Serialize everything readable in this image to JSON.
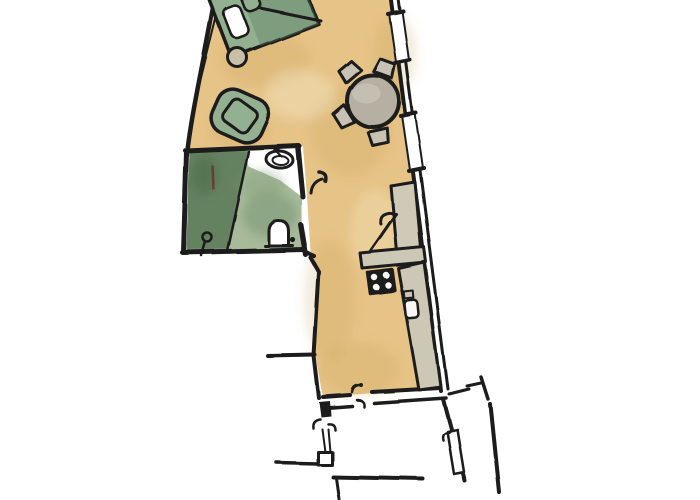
{
  "colors": {
    "paper": "#ffffff",
    "outline": "#1d1d1b",
    "floor": "#e6c387",
    "floor_shade": "#c59c4f",
    "green": "#93b191",
    "green_dark": "#5d7f5f",
    "bath": "#a7bb9a",
    "shower": "#5f7d5c",
    "table": "#b5b0a2",
    "chair": "#c7c2b3",
    "counter": "#cdc7b5",
    "cabinet": "#cfc9b8",
    "side_table": "#c9bfa9",
    "stove": "#1e1e1c",
    "red_mark": "#70302a"
  },
  "inventory": {
    "rooms": [
      "living-sleeping-area",
      "bathroom",
      "kitchen-corridor",
      "entry-stair-landing"
    ],
    "furniture": [
      "bed",
      "bed-pillow",
      "side-table",
      "armchair",
      "dining-table",
      "dining-chair",
      "bathroom-sink",
      "toilet",
      "shower-area",
      "floor-drain",
      "tall-cabinet",
      "kitchen-counter",
      "stove",
      "kitchen-sink"
    ],
    "openings": [
      "window",
      "window",
      "door-swing",
      "door-swing",
      "door-swing",
      "door-leaf"
    ],
    "dining_chair_count": 4,
    "window_count": 2,
    "stove_burner_count": 4
  }
}
